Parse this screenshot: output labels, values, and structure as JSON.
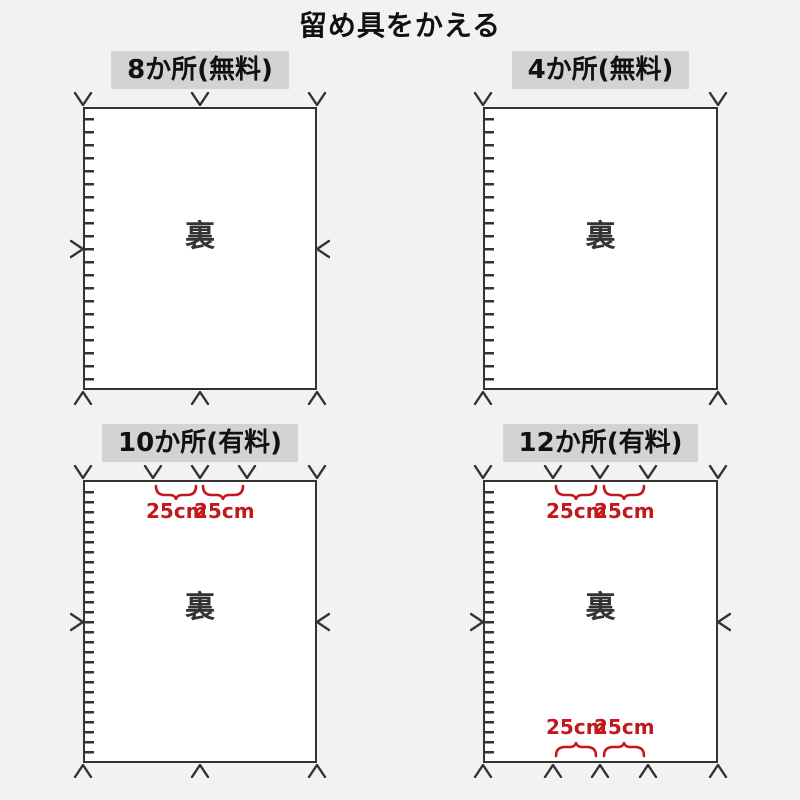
{
  "title": "留め具をかえる",
  "back_label": "裏",
  "spacing_label": "25cm",
  "panels": [
    {
      "label": "8か所(無料)",
      "fee": "無料",
      "marks": {
        "top": 3,
        "bottom": 3,
        "left": 1,
        "right": 1
      }
    },
    {
      "label": "4か所(無料)",
      "fee": "無料",
      "marks": {
        "top": 2,
        "bottom": 2,
        "left": 0,
        "right": 0
      }
    },
    {
      "label": "10か所(有料)",
      "fee": "有料",
      "marks": {
        "top": 5,
        "bottom": 3,
        "left": 1,
        "right": 1
      },
      "spacing_annotations": [
        "top"
      ]
    },
    {
      "label": "12か所(有料)",
      "fee": "有料",
      "marks": {
        "top": 5,
        "bottom": 5,
        "left": 1,
        "right": 1
      },
      "spacing_annotations": [
        "top",
        "bottom"
      ]
    }
  ],
  "colors": {
    "background": "#f2f2f3",
    "label_box_bg": "#d3d3d3",
    "line": "#333333",
    "red": "#c2181e",
    "panel_bg": "#ffffff"
  }
}
